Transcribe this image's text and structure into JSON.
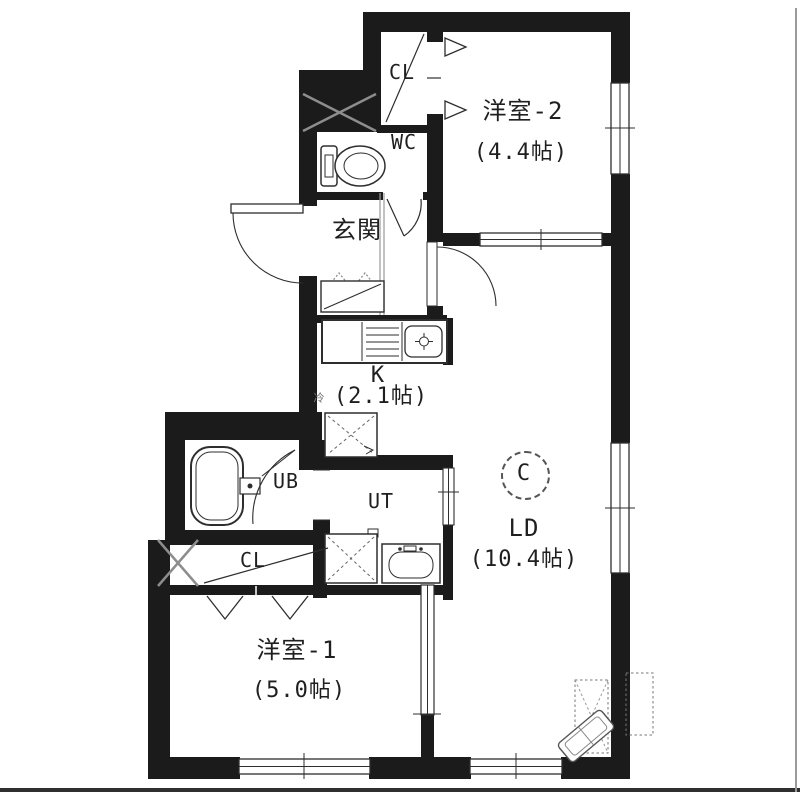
{
  "colors": {
    "wall": "#1b1b1b",
    "line": "#2e2e2e",
    "gray": "#8d8d8d",
    "bg": "#ffffff"
  },
  "rooms": {
    "western2": {
      "name": "洋室-2",
      "size": "(4.4帖)"
    },
    "western1": {
      "name": "洋室-1",
      "size": "(5.0帖)"
    },
    "living_dining": {
      "name": "LD",
      "size": "(10.4帖)"
    },
    "kitchen": {
      "name": "K",
      "size": "(2.1帖)"
    },
    "entrance": {
      "name": "玄関"
    },
    "toilet": {
      "name": "WC"
    },
    "closet_top": {
      "name": "CL"
    },
    "closet_bottom": {
      "name": "CL"
    },
    "unit_bath": {
      "name": "UB"
    },
    "utility": {
      "name": "UT"
    }
  },
  "marks": {
    "circle_c": "C",
    "fridge": "冷"
  }
}
